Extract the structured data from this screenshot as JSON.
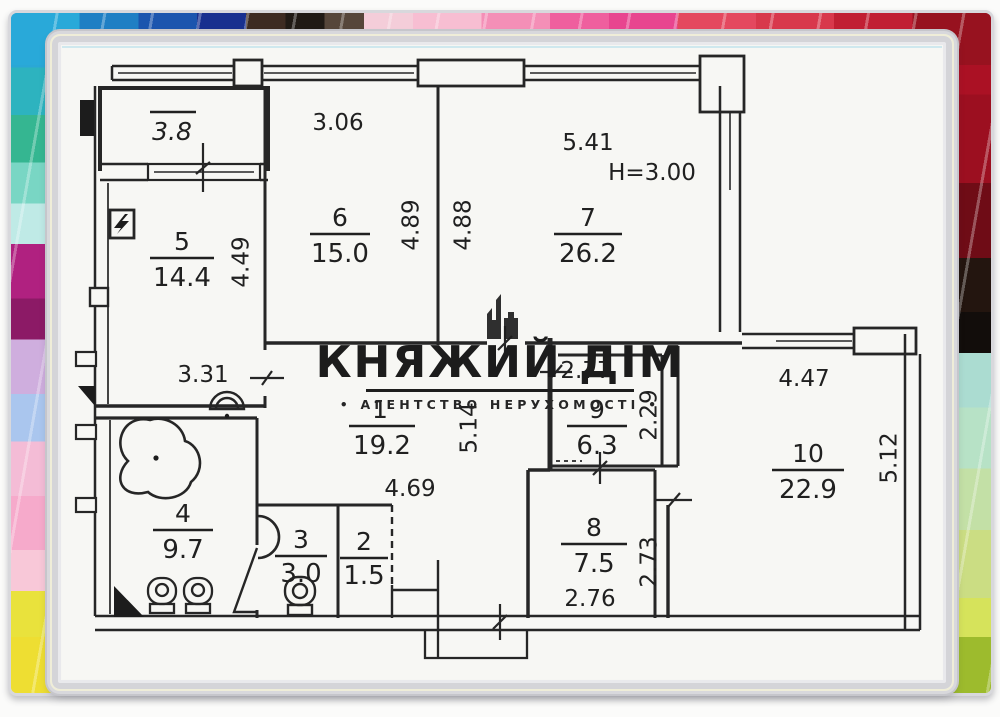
{
  "watermark": {
    "title": "КНЯЖИЙ ДІМ",
    "subtitle": "• АГЕНТСТВО НЕРУХОМОСТІ •"
  },
  "floor_plan": {
    "balcony_area": "3.8",
    "ceiling_height": "H=3.00",
    "rooms": [
      {
        "number": "1",
        "area": "19.2"
      },
      {
        "number": "2",
        "area": "1.5"
      },
      {
        "number": "3",
        "area": "3.0"
      },
      {
        "number": "4",
        "area": "9.7"
      },
      {
        "number": "5",
        "area": "14.4"
      },
      {
        "number": "6",
        "area": "15.0"
      },
      {
        "number": "7",
        "area": "26.2"
      },
      {
        "number": "8",
        "area": "7.5"
      },
      {
        "number": "9",
        "area": "6.3"
      },
      {
        "number": "10",
        "area": "22.9"
      }
    ],
    "dimensions": {
      "room5_height": "4.49",
      "room5_lower_width": "3.31",
      "room6_width": "3.06",
      "room6_height": "4.89",
      "room7_height": "4.88",
      "room7_width": "5.41",
      "hall_height": "5.14",
      "hall_width": "4.69",
      "room9_width": "2.77",
      "room9_height": "2.29",
      "room10_width": "4.47",
      "room10_height": "5.12",
      "room8_width": "2.76",
      "room8_height": "2.73"
    }
  }
}
